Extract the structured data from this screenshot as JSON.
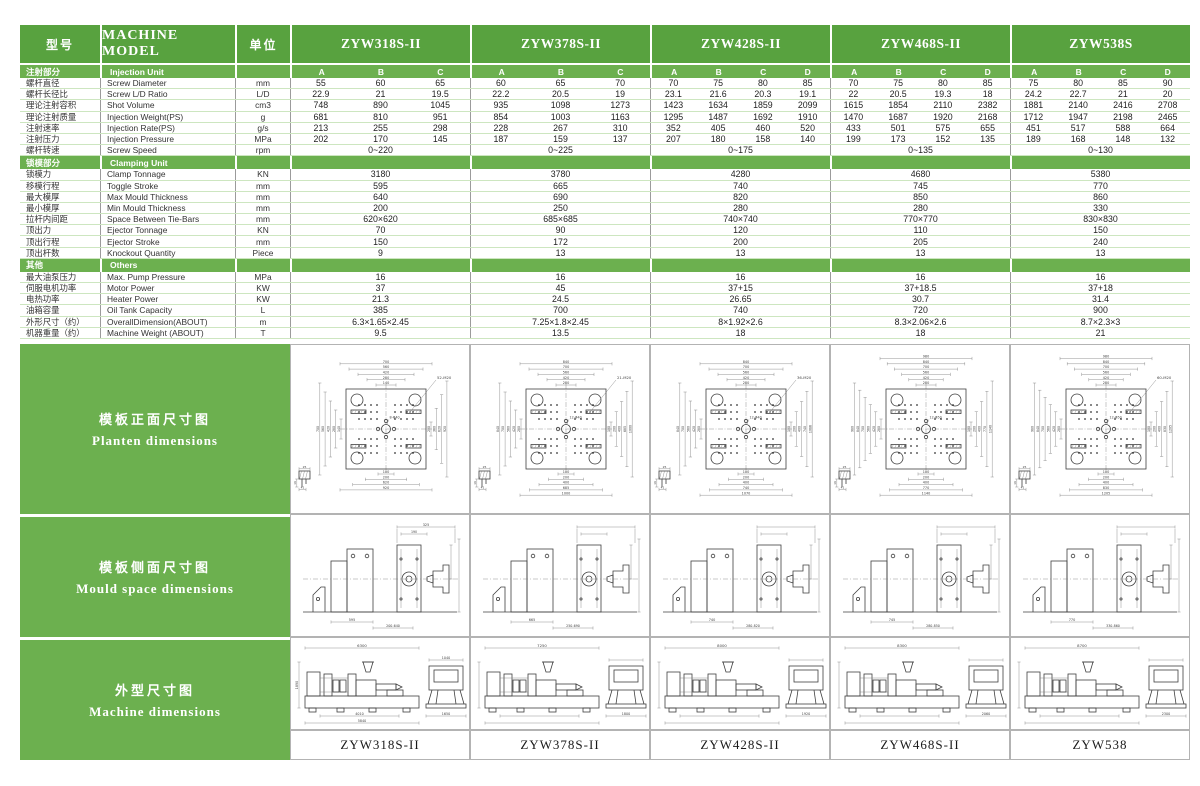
{
  "table": {
    "header": {
      "col_zh": "型号",
      "col_en": "MACHINE MODEL",
      "col_unit": "单位"
    },
    "models": [
      {
        "name": "ZYW318S-II",
        "variants": [
          "A",
          "B",
          "C"
        ]
      },
      {
        "name": "ZYW378S-II",
        "variants": [
          "A",
          "B",
          "C"
        ]
      },
      {
        "name": "ZYW428S-II",
        "variants": [
          "A",
          "B",
          "C",
          "D"
        ]
      },
      {
        "name": "ZYW468S-II",
        "variants": [
          "A",
          "B",
          "C",
          "D"
        ]
      },
      {
        "name": "ZYW538S",
        "variants": [
          "A",
          "B",
          "C",
          "D"
        ]
      }
    ],
    "sections": [
      {
        "zh": "注射部分",
        "en": "Injection Unit",
        "show_variants": true,
        "rows": [
          {
            "zh": "螺杆直径",
            "en": "Screw Diameter",
            "unit": "mm",
            "values": [
              [
                "55",
                "60",
                "65"
              ],
              [
                "60",
                "65",
                "70"
              ],
              [
                "70",
                "75",
                "80",
                "85"
              ],
              [
                "70",
                "75",
                "80",
                "85"
              ],
              [
                "75",
                "80",
                "85",
                "90"
              ]
            ]
          },
          {
            "zh": "螺杆长径比",
            "en": "Screw L/D Ratio",
            "unit": "L/D",
            "values": [
              [
                "22.9",
                "21",
                "19.5"
              ],
              [
                "22.2",
                "20.5",
                "19"
              ],
              [
                "23.1",
                "21.6",
                "20.3",
                "19.1"
              ],
              [
                "22",
                "20.5",
                "19.3",
                "18"
              ],
              [
                "24.2",
                "22.7",
                "21",
                "20"
              ]
            ]
          },
          {
            "zh": "理论注射容积",
            "en": "Shot Volume",
            "unit": "cm3",
            "values": [
              [
                "748",
                "890",
                "1045"
              ],
              [
                "935",
                "1098",
                "1273"
              ],
              [
                "1423",
                "1634",
                "1859",
                "2099"
              ],
              [
                "1615",
                "1854",
                "2110",
                "2382"
              ],
              [
                "1881",
                "2140",
                "2416",
                "2708"
              ]
            ]
          },
          {
            "zh": "理论注射质量",
            "en": "Injection Weight(PS)",
            "unit": "g",
            "values": [
              [
                "681",
                "810",
                "951"
              ],
              [
                "854",
                "1003",
                "1163"
              ],
              [
                "1295",
                "1487",
                "1692",
                "1910"
              ],
              [
                "1470",
                "1687",
                "1920",
                "2168"
              ],
              [
                "1712",
                "1947",
                "2198",
                "2465"
              ]
            ]
          },
          {
            "zh": "注射速率",
            "en": "Injection Rate(PS)",
            "unit": "g/s",
            "values": [
              [
                "213",
                "255",
                "298"
              ],
              [
                "228",
                "267",
                "310"
              ],
              [
                "352",
                "405",
                "460",
                "520"
              ],
              [
                "433",
                "501",
                "575",
                "655"
              ],
              [
                "451",
                "517",
                "588",
                "664"
              ]
            ]
          },
          {
            "zh": "注射压力",
            "en": "Injection Pressure",
            "unit": "MPa",
            "values": [
              [
                "202",
                "170",
                "145"
              ],
              [
                "187",
                "159",
                "137"
              ],
              [
                "207",
                "180",
                "158",
                "140"
              ],
              [
                "199",
                "173",
                "152",
                "135"
              ],
              [
                "189",
                "168",
                "148",
                "132"
              ]
            ]
          },
          {
            "zh": "螺杆转速",
            "en": "Screw Speed",
            "unit": "rpm",
            "values": [
              [
                "0~220"
              ],
              [
                "0~225"
              ],
              [
                "0~175"
              ],
              [
                "0~135"
              ],
              [
                "0~130"
              ]
            ]
          }
        ]
      },
      {
        "zh": "锁模部分",
        "en": "Clamping Unit",
        "show_variants": false,
        "rows": [
          {
            "zh": "锁模力",
            "en": "Clamp Tonnage",
            "unit": "KN",
            "values": [
              [
                "3180"
              ],
              [
                "3780"
              ],
              [
                "4280"
              ],
              [
                "4680"
              ],
              [
                "5380"
              ]
            ]
          },
          {
            "zh": "移模行程",
            "en": "Toggle Stroke",
            "unit": "mm",
            "values": [
              [
                "595"
              ],
              [
                "665"
              ],
              [
                "740"
              ],
              [
                "745"
              ],
              [
                "770"
              ]
            ]
          },
          {
            "zh": "最大模厚",
            "en": "Max  Mould Thickness",
            "unit": "mm",
            "values": [
              [
                "640"
              ],
              [
                "690"
              ],
              [
                "820"
              ],
              [
                "850"
              ],
              [
                "860"
              ]
            ]
          },
          {
            "zh": "最小模厚",
            "en": "Min  Mould Thickness",
            "unit": "mm",
            "values": [
              [
                "200"
              ],
              [
                "250"
              ],
              [
                "280"
              ],
              [
                "280"
              ],
              [
                "330"
              ]
            ]
          },
          {
            "zh": "拉杆内间距",
            "en": "Space Between Tie-Bars",
            "unit": "mm",
            "values": [
              [
                "620×620"
              ],
              [
                "685×685"
              ],
              [
                "740×740"
              ],
              [
                "770×770"
              ],
              [
                "830×830"
              ]
            ]
          },
          {
            "zh": "顶出力",
            "en": "Ejector Tonnage",
            "unit": "KN",
            "values": [
              [
                "70"
              ],
              [
                "90"
              ],
              [
                "120"
              ],
              [
                "110"
              ],
              [
                "150"
              ]
            ]
          },
          {
            "zh": "顶出行程",
            "en": "Ejector Stroke",
            "unit": "mm",
            "values": [
              [
                "150"
              ],
              [
                "172"
              ],
              [
                "200"
              ],
              [
                "205"
              ],
              [
                "240"
              ]
            ]
          },
          {
            "zh": "顶出杆数",
            "en": "Knockout Quantity",
            "unit": "Piece",
            "values": [
              [
                "9"
              ],
              [
                "13"
              ],
              [
                "13"
              ],
              [
                "13"
              ],
              [
                "13"
              ]
            ]
          }
        ]
      },
      {
        "zh": "其他",
        "en": "Others",
        "show_variants": false,
        "rows": [
          {
            "zh": "最大油泵压力",
            "en": "Max. Pump Pressure",
            "unit": "MPa",
            "values": [
              [
                "16"
              ],
              [
                "16"
              ],
              [
                "16"
              ],
              [
                "16"
              ],
              [
                "16"
              ]
            ]
          },
          {
            "zh": "伺服电机功率",
            "en": "Motor Power",
            "unit": "KW",
            "values": [
              [
                "37"
              ],
              [
                "45"
              ],
              [
                "37+15"
              ],
              [
                "37+18.5"
              ],
              [
                "37+18"
              ]
            ]
          },
          {
            "zh": "电热功率",
            "en": "Heater Power",
            "unit": "KW",
            "values": [
              [
                "21.3"
              ],
              [
                "24.5"
              ],
              [
                "26.65"
              ],
              [
                "30.7"
              ],
              [
                "31.4"
              ]
            ]
          },
          {
            "zh": "油箱容量",
            "en": "Oil Tank Capacity",
            "unit": "L",
            "values": [
              [
                "385"
              ],
              [
                "700"
              ],
              [
                "740"
              ],
              [
                "720"
              ],
              [
                "900"
              ]
            ]
          },
          {
            "zh": "外形尺寸（约）",
            "en": "OverallDimension(ABOUT)",
            "unit": "m",
            "values": [
              [
                "6.3×1.65×2.45"
              ],
              [
                "7.25×1.8×2.45"
              ],
              [
                "8×1.92×2.6"
              ],
              [
                "8.3×2.06×2.6"
              ],
              [
                "8.7×2.3×3"
              ]
            ]
          },
          {
            "zh": "机器重量（约）",
            "en": "Machine Weight (ABOUT)",
            "unit": "T",
            "values": [
              [
                "9.5"
              ],
              [
                "13.5"
              ],
              [
                "18"
              ],
              [
                "18"
              ],
              [
                "21"
              ]
            ]
          }
        ]
      }
    ]
  },
  "drawings": {
    "row_labels": [
      {
        "zh": "模板正面尺寸图",
        "en": "Planten  dimensions"
      },
      {
        "zh": "模板侧面尺寸图",
        "en": "Mould  space  dimensions"
      },
      {
        "zh": "外型尺寸图",
        "en": "Machine  dimensions"
      }
    ],
    "platen": [
      {
        "top": [
          "700",
          "560",
          "420",
          "280",
          "140"
        ],
        "bottom": [
          "100",
          "200",
          "620",
          "920"
        ],
        "left": [
          "700",
          "560",
          "420",
          "280",
          "140"
        ],
        "right": [
          "200",
          "360",
          "620",
          "920"
        ],
        "callout": "52-M20",
        "center": "8-Φ40",
        "detail": [
          "25",
          "16",
          "41"
        ]
      },
      {
        "top": [
          "840",
          "700",
          "560",
          "420",
          "280"
        ],
        "bottom": [
          "100",
          "200",
          "400",
          "685",
          "1000"
        ],
        "left": [
          "840",
          "700",
          "560",
          "420",
          "280"
        ],
        "right": [
          "100",
          "200",
          "400",
          "685",
          "1000"
        ],
        "callout": "21-M20",
        "center": "12-Φ40",
        "detail": [
          "25",
          "16",
          "41"
        ]
      },
      {
        "top": [
          "840",
          "700",
          "560",
          "420",
          "280"
        ],
        "bottom": [
          "100",
          "200",
          "400",
          "740",
          "1070"
        ],
        "left": [
          "840",
          "700",
          "560",
          "420",
          "280"
        ],
        "right": [
          "100",
          "200",
          "400",
          "740",
          "1086"
        ],
        "callout": "36-M20",
        "center": "12-Φ40",
        "detail": [
          "25",
          "16",
          "41"
        ]
      },
      {
        "top": [
          "980",
          "840",
          "700",
          "560",
          "420",
          "280"
        ],
        "bottom": [
          "100",
          "200",
          "400",
          "770",
          "1140"
        ],
        "left": [
          "980",
          "840",
          "700",
          "560",
          "420",
          "280"
        ],
        "right": [
          "100",
          "200",
          "400",
          "770",
          "1140"
        ],
        "callout": "",
        "center": "12-Φ50",
        "detail": [
          "25",
          "16",
          "41"
        ]
      },
      {
        "top": [
          "980",
          "840",
          "700",
          "560",
          "420",
          "280"
        ],
        "bottom": [
          "100",
          "200",
          "400",
          "830",
          "1205"
        ],
        "left": [
          "980",
          "840",
          "700",
          "560",
          "420",
          "280"
        ],
        "right": [
          "100",
          "200",
          "400",
          "830",
          "1205"
        ],
        "callout": "60-M20",
        "center": "12-Φ50",
        "detail": [
          "25",
          "16",
          "41"
        ]
      }
    ],
    "mould_space": [
      {
        "top": [
          "325",
          "190"
        ],
        "stroke": "595",
        "range": "200-640"
      },
      {
        "top": [
          "",
          ""
        ],
        "stroke": "665",
        "range": "250-690"
      },
      {
        "top": [
          "",
          ""
        ],
        "stroke": "740",
        "range": "280-820"
      },
      {
        "top": [
          "",
          ""
        ],
        "stroke": "745",
        "range": "280-850"
      },
      {
        "top": [
          "",
          ""
        ],
        "stroke": "770",
        "range": "330-860"
      }
    ],
    "machine": [
      {
        "length": "6300",
        "height": "1890",
        "base": [
          "4010",
          "5840"
        ],
        "end_top": "1040",
        "end_width": "1650"
      },
      {
        "length": "7250",
        "height": "",
        "base": [
          "",
          ""
        ],
        "end_top": "",
        "end_width": "1800"
      },
      {
        "length": "8000",
        "height": "",
        "base": [
          "",
          ""
        ],
        "end_top": "",
        "end_width": "1920"
      },
      {
        "length": "8300",
        "height": "",
        "base": [
          "",
          ""
        ],
        "end_top": "",
        "end_width": "2060"
      },
      {
        "length": "8700",
        "height": "",
        "base": [
          "",
          ""
        ],
        "end_top": "",
        "end_width": "2300"
      }
    ],
    "footer_models": [
      "ZYW318S-II",
      "ZYW378S-II",
      "ZYW428S-II",
      "ZYW468S-II",
      "ZYW538"
    ]
  }
}
